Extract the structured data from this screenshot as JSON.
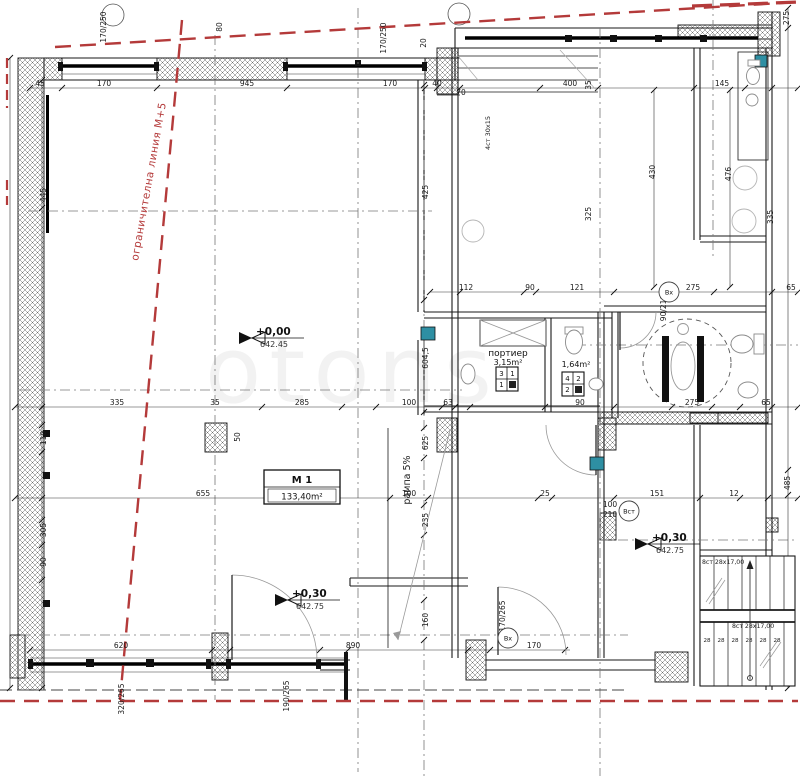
{
  "boundary": {
    "label": "ограничителна линия М+5"
  },
  "rooms": {
    "m1": {
      "name": "M 1",
      "area": "133,40m²"
    },
    "porter": {
      "name": "портиер",
      "area": "3,15m²"
    },
    "wc": {
      "area": "1,64m²"
    }
  },
  "ramp": {
    "label": "рампа 5%"
  },
  "stairs": {
    "exterior": "4ст 30х15",
    "flight_upper": "8ст 28х17,00",
    "flight_lower": "8ст 28х17,00"
  },
  "watermark": "otons",
  "levels": [
    {
      "value": "+0,00",
      "elevation": "642.45",
      "x": 252,
      "y": 338
    },
    {
      "value": "+0,30",
      "elevation": "642.75",
      "x": 288,
      "y": 600
    },
    {
      "value": "+0,30",
      "elevation": "642.75",
      "x": 648,
      "y": 544
    }
  ],
  "door_tags": [
    {
      "text": "Вх",
      "x": 669,
      "y": 292
    },
    {
      "text": "Вст",
      "x": 629,
      "y": 511
    },
    {
      "text": "Вх",
      "x": 508,
      "y": 638
    }
  ],
  "vent_grids": [
    {
      "cells": [
        "3",
        "1",
        "1",
        ""
      ],
      "x": 496,
      "y": 367
    },
    {
      "cells": [
        "4",
        "2",
        "2",
        ""
      ],
      "x": 562,
      "y": 372
    }
  ],
  "dims": [
    {
      "t": "45",
      "x": 40,
      "y": 86
    },
    {
      "t": "170",
      "x": 104,
      "y": 86
    },
    {
      "t": "945",
      "x": 247,
      "y": 86
    },
    {
      "t": "170",
      "x": 390,
      "y": 86
    },
    {
      "t": "40",
      "x": 437,
      "y": 86
    },
    {
      "t": "70",
      "x": 461,
      "y": 95
    },
    {
      "t": "400",
      "x": 570,
      "y": 86
    },
    {
      "t": "145",
      "x": 722,
      "y": 86
    },
    {
      "t": "112",
      "x": 466,
      "y": 290
    },
    {
      "t": "90",
      "x": 530,
      "y": 290
    },
    {
      "t": "121",
      "x": 577,
      "y": 290
    },
    {
      "t": "275",
      "x": 693,
      "y": 290
    },
    {
      "t": "65",
      "x": 791,
      "y": 290
    },
    {
      "t": "335",
      "x": 117,
      "y": 405
    },
    {
      "t": "35",
      "x": 215,
      "y": 405
    },
    {
      "t": "285",
      "x": 302,
      "y": 405
    },
    {
      "t": "100",
      "x": 409,
      "y": 405
    },
    {
      "t": "63",
      "x": 448,
      "y": 405
    },
    {
      "t": "90",
      "x": 580,
      "y": 405
    },
    {
      "t": "275",
      "x": 692,
      "y": 405
    },
    {
      "t": "65",
      "x": 766,
      "y": 405
    },
    {
      "t": "655",
      "x": 203,
      "y": 496
    },
    {
      "t": "100",
      "x": 409,
      "y": 496
    },
    {
      "t": "25",
      "x": 545,
      "y": 496
    },
    {
      "t": "151",
      "x": 657,
      "y": 496
    },
    {
      "t": "12",
      "x": 734,
      "y": 496
    },
    {
      "t": "620",
      "x": 121,
      "y": 648
    },
    {
      "t": "890",
      "x": 353,
      "y": 648
    },
    {
      "t": "170",
      "x": 534,
      "y": 648
    },
    {
      "t": "100",
      "x": 610,
      "y": 507
    },
    {
      "t": "210",
      "x": 610,
      "y": 517
    },
    {
      "t": "28",
      "x": 707,
      "y": 642,
      "s": 1
    },
    {
      "t": "28",
      "x": 721,
      "y": 642,
      "s": 1
    },
    {
      "t": "28",
      "x": 735,
      "y": 642,
      "s": 1
    },
    {
      "t": "28",
      "x": 749,
      "y": 642,
      "s": 1
    },
    {
      "t": "28",
      "x": 763,
      "y": 642,
      "s": 1
    },
    {
      "t": "28",
      "x": 777,
      "y": 642,
      "s": 1
    },
    {
      "t": "170/250",
      "x": 106,
      "y": 27,
      "rot": -90
    },
    {
      "t": "80",
      "x": 222,
      "y": 27,
      "rot": -90
    },
    {
      "t": "170/250",
      "x": 386,
      "y": 38,
      "rot": -90
    },
    {
      "t": "20",
      "x": 426,
      "y": 43,
      "rot": -90
    },
    {
      "t": "35",
      "x": 591,
      "y": 85,
      "rot": -90
    },
    {
      "t": "445",
      "x": 46,
      "y": 195,
      "rot": -90
    },
    {
      "t": "110",
      "x": 46,
      "y": 438,
      "rot": -90
    },
    {
      "t": "305",
      "x": 46,
      "y": 530,
      "rot": -90
    },
    {
      "t": "90",
      "x": 46,
      "y": 562,
      "rot": -90
    },
    {
      "t": "425",
      "x": 428,
      "y": 192,
      "rot": -90
    },
    {
      "t": "604,5",
      "x": 428,
      "y": 358,
      "rot": -90
    },
    {
      "t": "625",
      "x": 428,
      "y": 443,
      "rot": -90
    },
    {
      "t": "235",
      "x": 428,
      "y": 520,
      "rot": -90
    },
    {
      "t": "160",
      "x": 428,
      "y": 620,
      "rot": -90
    },
    {
      "t": "50",
      "x": 240,
      "y": 437,
      "rot": -90
    },
    {
      "t": "430",
      "x": 655,
      "y": 172,
      "rot": -90
    },
    {
      "t": "476",
      "x": 731,
      "y": 174,
      "rot": -90
    },
    {
      "t": "325",
      "x": 591,
      "y": 214,
      "rot": -90
    },
    {
      "t": "335",
      "x": 773,
      "y": 217,
      "rot": -90
    },
    {
      "t": "275",
      "x": 789,
      "y": 18,
      "rot": -90
    },
    {
      "t": "485",
      "x": 790,
      "y": 483,
      "rot": -90
    },
    {
      "t": "90/210",
      "x": 666,
      "y": 308,
      "rot": -90
    },
    {
      "t": "170/265",
      "x": 505,
      "y": 616,
      "rot": -90
    },
    {
      "t": "190/265",
      "x": 289,
      "y": 696,
      "rot": -90
    },
    {
      "t": "320/265",
      "x": 124,
      "y": 699,
      "rot": -90
    }
  ]
}
